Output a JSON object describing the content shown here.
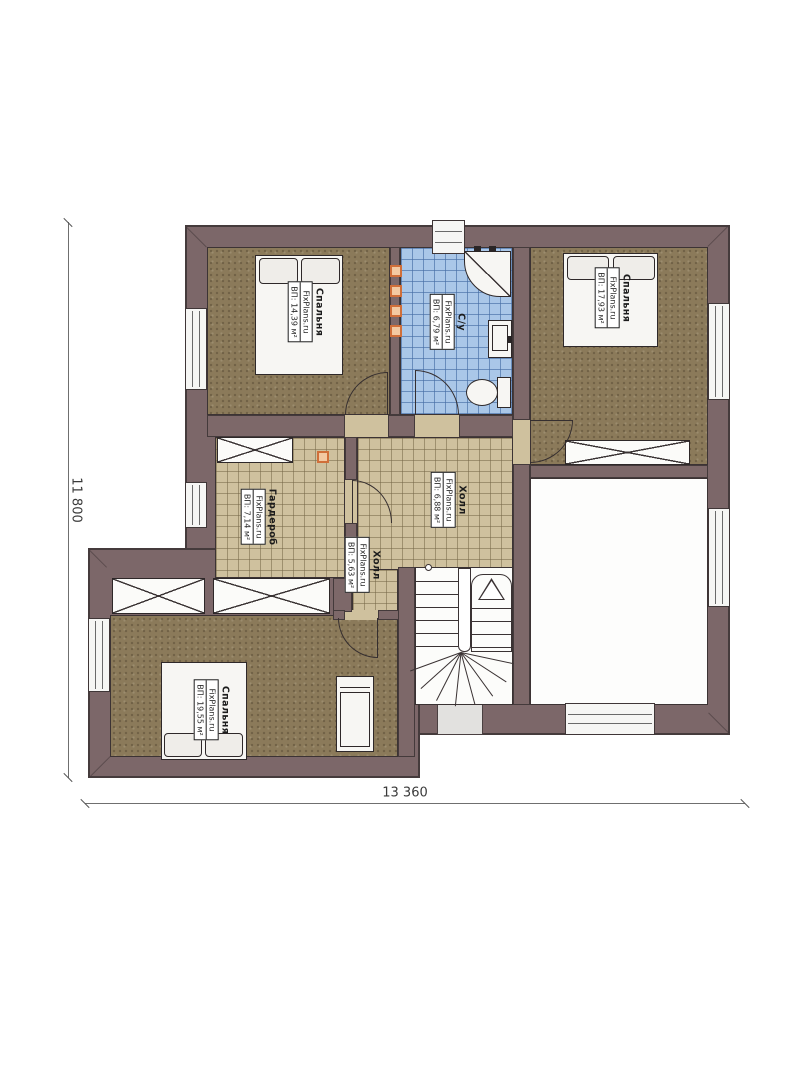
{
  "plan": {
    "type": "floor-plan",
    "brand_watermark": "FixPlans.ru",
    "dimensions": {
      "overall_height_mm": "11 800",
      "overall_width_mm": "13 360"
    },
    "rooms": {
      "bedroom_tl": {
        "name": "Спальня",
        "watermark": "FixPlans.ru",
        "area": "ВП: 14,39 м²"
      },
      "bathroom": {
        "name": "С/у",
        "watermark": "FixPlans.ru",
        "area": "ВП: 6,79 м²"
      },
      "bedroom_tr": {
        "name": "Спальня",
        "watermark": "FixPlans.ru",
        "area": "ВП: 17,93 м²"
      },
      "hall_main": {
        "name": "Холл",
        "watermark": "FixPlans.ru",
        "area": "ВП: 6,88 м²"
      },
      "wardrobe": {
        "name": "Гардероб",
        "watermark": "FixPlans.ru",
        "area": "ВП: 7,14 м²"
      },
      "hall_small": {
        "name": "Холл",
        "watermark": "FixPlans.ru",
        "area": "ВП: 5,63 м²"
      },
      "bedroom_bl": {
        "name": "Спальня",
        "watermark": "FixPlans.ru",
        "area": "ВП: 19,55 м²"
      }
    },
    "colors": {
      "wall": "#7c6769",
      "wall_outline": "#453b3c",
      "bedroom_floor": "#8b7a5a",
      "bathroom_tile": "#aac7e8",
      "hall_tile": "#cfc19e",
      "accent_marker": "#d06f3a",
      "background": "#ffffff"
    }
  }
}
